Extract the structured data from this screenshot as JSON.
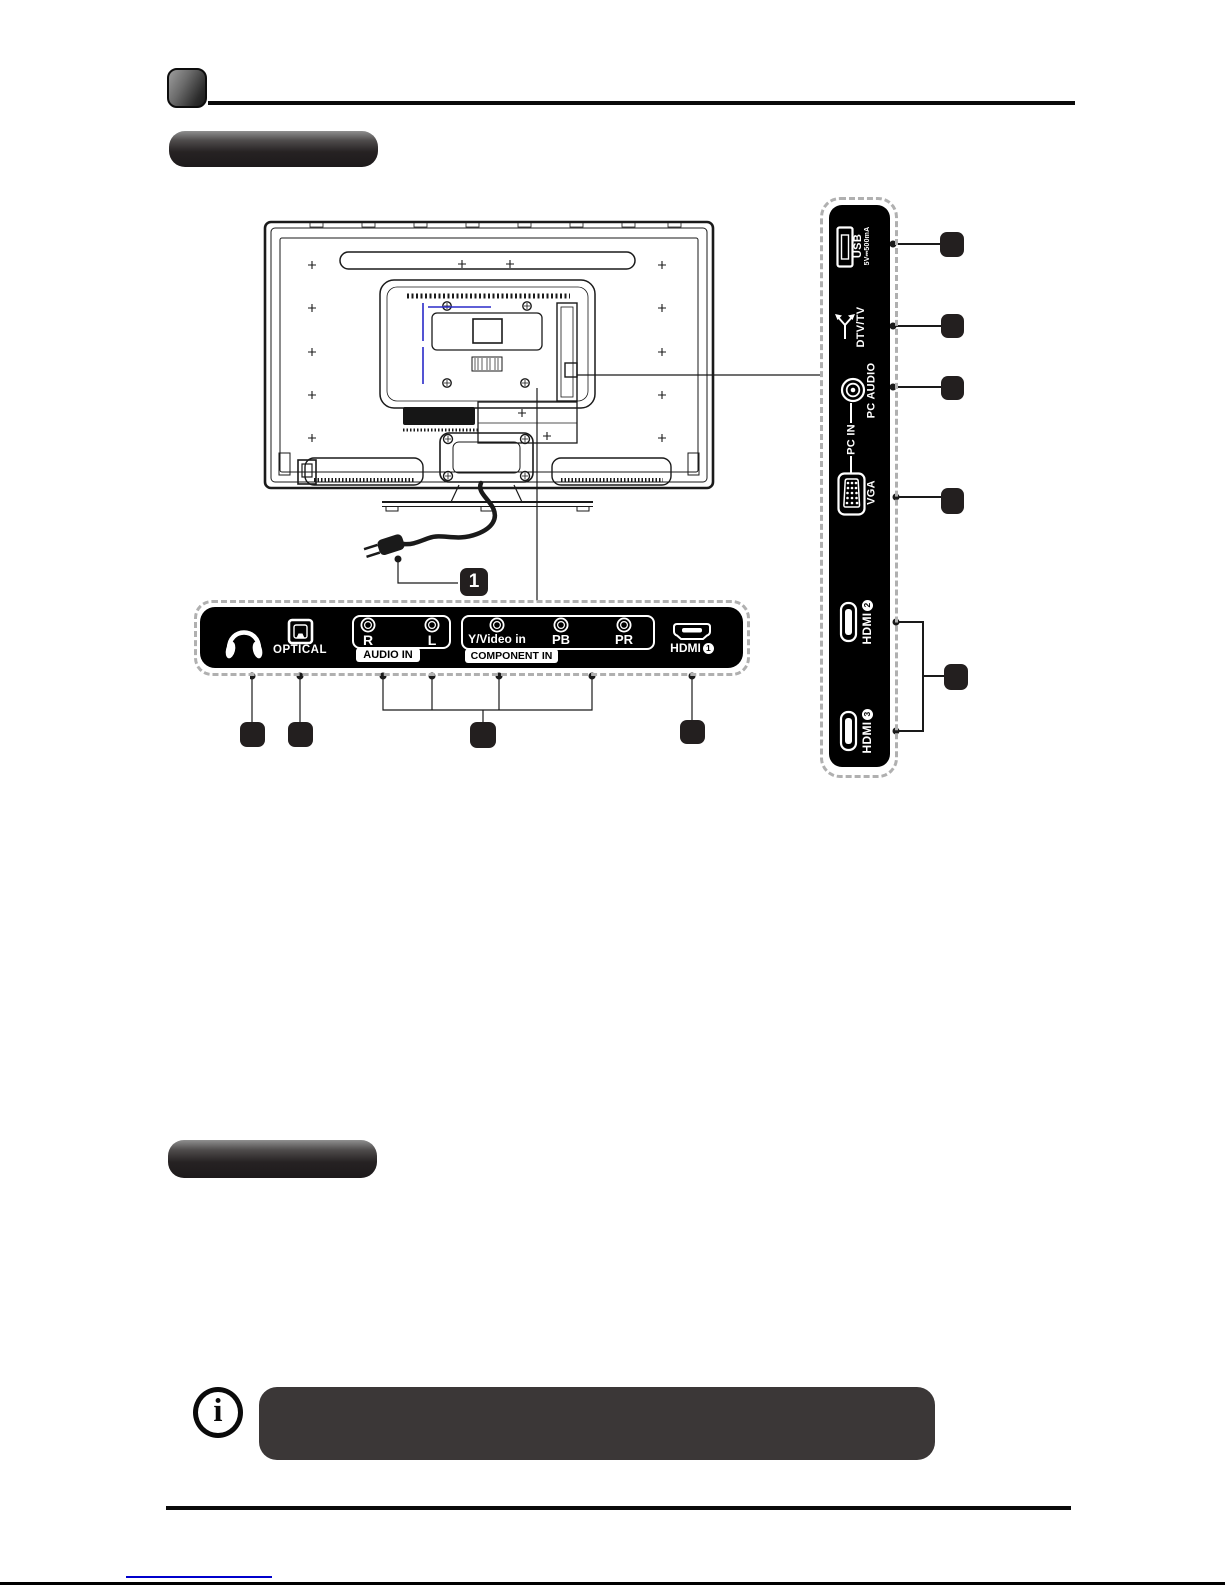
{
  "colors": {
    "panel_black": "#000000",
    "badge_dark": "#231f1f",
    "note_box_gray": "#3b3737",
    "accent_blue": "#2a2ac8",
    "dashed_gray": "#b0b0b0",
    "link_blue": "#0000cc"
  },
  "diagram": {
    "power_callout_number": "1",
    "side_panel": {
      "usb": {
        "label": "USB",
        "spec": "5V⎓500mA"
      },
      "antenna": {
        "label": "DTV/TV"
      },
      "pc_audio": {
        "label": "PC AUDIO"
      },
      "pc_in": {
        "label": "PC IN"
      },
      "vga": {
        "label": "VGA"
      },
      "hdmi2": {
        "label": "HDMI",
        "number": "2"
      },
      "hdmi3": {
        "label": "HDMI",
        "number": "3"
      }
    },
    "bottom_panel": {
      "optical": {
        "label": "OPTICAL"
      },
      "audio_in": {
        "tab": "AUDIO IN",
        "jack_r": "R",
        "jack_l": "L"
      },
      "component_in": {
        "tab": "COMPONENT IN",
        "jack_y": "Y/Video in",
        "jack_pb": "PB",
        "jack_pr": "PR"
      },
      "hdmi1": {
        "label": "HDMI",
        "number": "1"
      }
    }
  },
  "note": {
    "icon_glyph": "i"
  }
}
